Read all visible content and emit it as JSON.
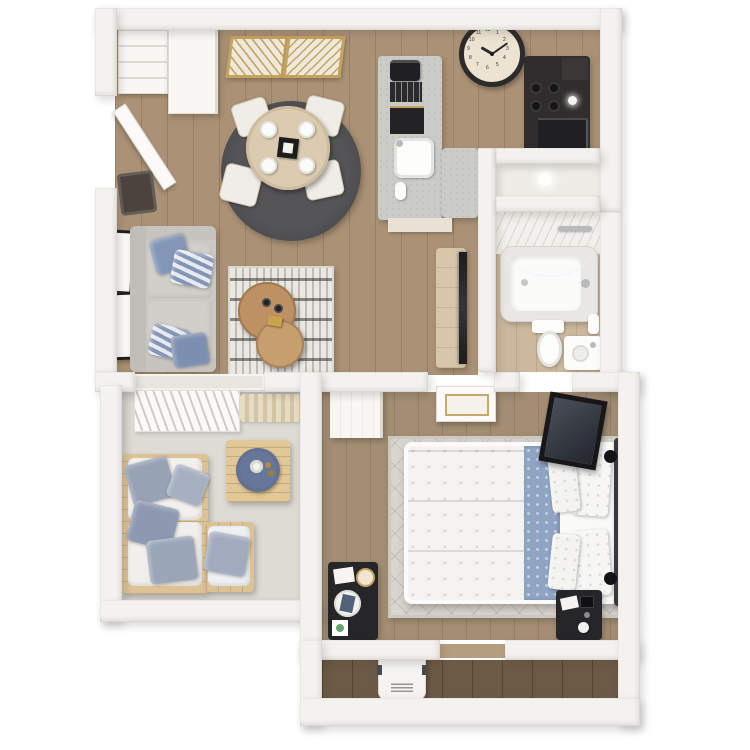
{
  "meta": {
    "description": "3D top-down rendering of a one-bedroom, one-bathroom apartment floor plan with balcony",
    "view": "bird's-eye 3D render",
    "canvas_px": 750
  },
  "colors": {
    "bg": "#ffffff",
    "wall": "#f4f2ee",
    "wall_edge": "#d9d5cf",
    "wood_floor": "#ab9276",
    "bedroom_floor": "#a38d73",
    "bathroom_floor": "#cbb89e",
    "hallway_floor": "#6d5a46",
    "balcony_floor": "#dedbd5",
    "closet_floor": "#eeece7",
    "dining_rug": "#4b4a4c",
    "living_rug": "#eae8e3",
    "bedroom_rug": "#d8d5d0",
    "sofa_gray": "#cbc9c4",
    "pillow_blue": "#8496b6",
    "coffee_table_wood": "#bd9163",
    "pallet_wood": "#ddc296",
    "tray_blue": "#5e7090",
    "island_concrete": "#cbcbc7",
    "counter_dark": "#2f2d2d",
    "black_furniture": "#262628",
    "gold": "#c3a35e",
    "clock_face": "#ece3d0",
    "clock_rim": "#2b2b2b",
    "tv_dark": "#1d1d1f",
    "bed_white": "#f5f3ef",
    "bed_blue": "#90a4c4",
    "headboard": "#39393b",
    "door_white": "#fbfaf8",
    "chrome": "#b9babd",
    "green_accent": "#67a46b"
  },
  "clock": {
    "time_shown": "10:10",
    "numerals": [
      "12",
      "1",
      "2",
      "3",
      "4",
      "5",
      "6",
      "7",
      "8",
      "9",
      "10",
      "11"
    ]
  },
  "rooms": {
    "kitchen_dining": {
      "items": [
        "gold-wall-mirrors",
        "wall-clock",
        "shelf-cabinet",
        "pantry-cabinet",
        "entry-door",
        "entry-doormat",
        "kitchen-island",
        "espresso-machine",
        "utensil-tray",
        "island-shelf",
        "island-sink",
        "paper-towel-roll",
        "cooktop-counter",
        "refrigerator",
        "round-dining-rug",
        "dining-table",
        "dinner-plates",
        "dining-chairs"
      ]
    },
    "living_room": {
      "items": [
        "gray-sofa",
        "striped-throw-pillows",
        "leaning-art-frames",
        "patterned-area-rug",
        "nesting-coffee-tables",
        "coffee-cups",
        "gold-box",
        "tv-console",
        "television"
      ]
    },
    "bathroom": {
      "items": [
        "bathtub",
        "tile-surround",
        "shower-glass",
        "towel-bar",
        "toilet",
        "vanity-sink",
        "towels"
      ]
    },
    "storage_closet": {
      "items": [
        "closet-light"
      ]
    },
    "bedroom": {
      "items": [
        "queen-bed",
        "white-duvet",
        "blue-folded-comforter",
        "bed-pillows",
        "dark-headboard",
        "area-rug",
        "black-desk",
        "desk-clock",
        "desk-tray",
        "desk-papers",
        "black-nightstand",
        "leaning-mirror",
        "bedroom-door",
        "sliding-door-panel"
      ]
    },
    "balcony": {
      "items": [
        "vertical-blinds",
        "striped-doormat",
        "pallet-sectional-sofa",
        "white-cushions",
        "blue-pillows",
        "pallet-coffee-table",
        "round-blue-tray",
        "vase"
      ]
    },
    "hallway": {
      "items": [
        "water-heater-unit"
      ]
    }
  }
}
